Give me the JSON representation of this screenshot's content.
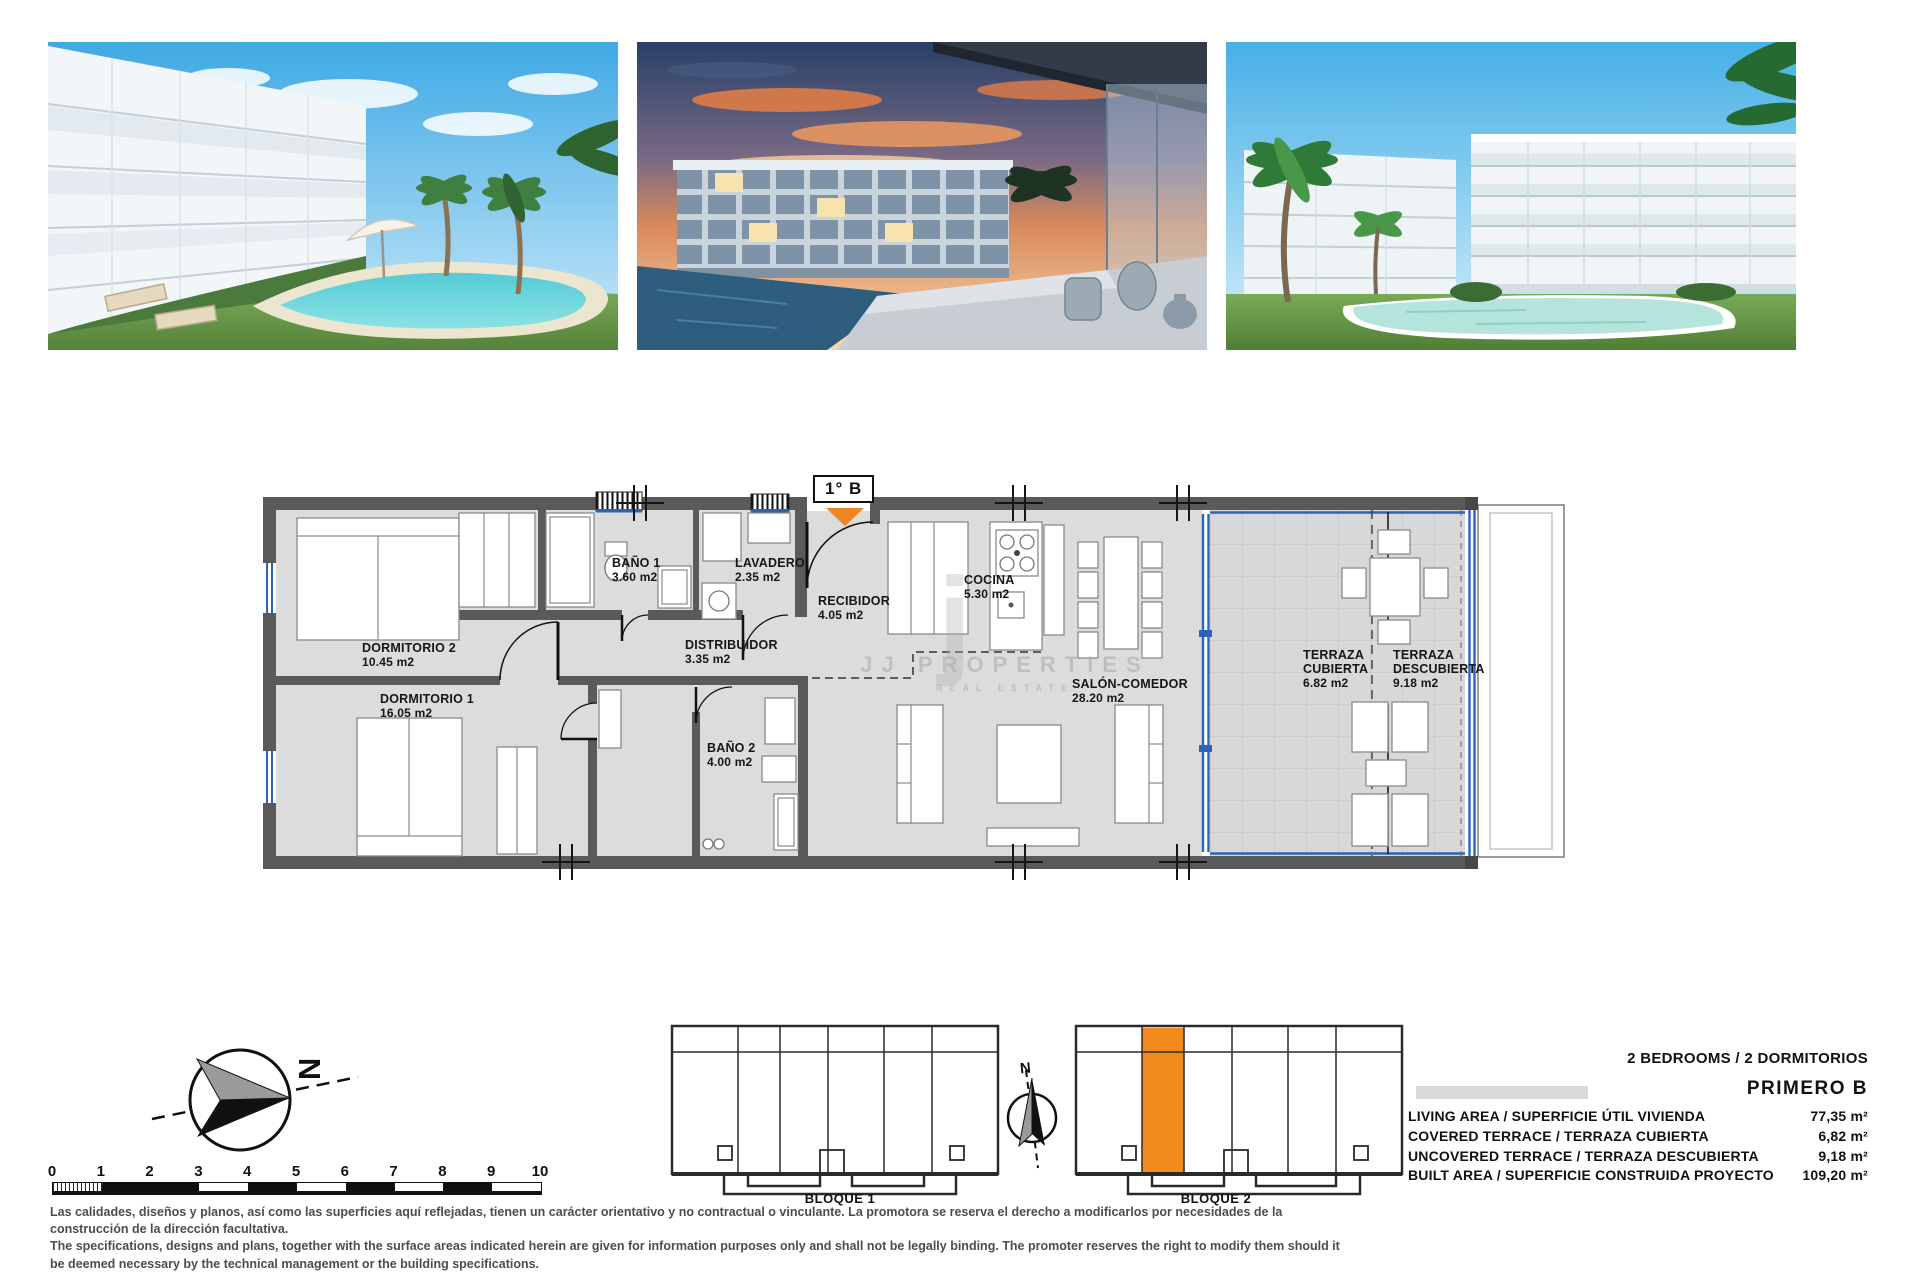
{
  "plan": {
    "unit_label": "1° B",
    "rooms": [
      {
        "name": "DORMITORIO 2",
        "area": "10.45 m2"
      },
      {
        "name": "DORMITORIO 1",
        "area": "16.05 m2"
      },
      {
        "name": "BAÑO 1",
        "area": "3.60 m2"
      },
      {
        "name": "LAVADERO",
        "area": "2.35 m2"
      },
      {
        "name": "RECIBIDOR",
        "area": "4.05 m2"
      },
      {
        "name": "DISTRIBUIDOR",
        "area": "3.35 m2"
      },
      {
        "name": "BAÑO 2",
        "area": "4.00 m2"
      },
      {
        "name": "COCINA",
        "area": "5.30 m2"
      },
      {
        "name": "SALÓN-COMEDOR",
        "area": "28.20 m2"
      },
      {
        "name": "TERRAZA CUBIERTA",
        "area": "6.82 m2"
      },
      {
        "name": "TERRAZA DESCUBIERTA",
        "area": "9.18 m2"
      }
    ],
    "watermark": {
      "initial": "j",
      "brand": "JJ PROPERTIES",
      "sub": "REAL ESTATE"
    }
  },
  "compass": {
    "north_label": "N"
  },
  "site": {
    "north_label": "N",
    "blocks": [
      {
        "label": "BLOQUE 1"
      },
      {
        "label": "BLOQUE 2"
      }
    ]
  },
  "scale_bar": {
    "labels": [
      "0",
      "1",
      "2",
      "3",
      "4",
      "5",
      "6",
      "7",
      "8",
      "9",
      "10"
    ]
  },
  "summary": {
    "bedrooms_line": "2 BEDROOMS / 2 DORMITORIOS",
    "unit_name": "PRIMERO B",
    "rows": [
      {
        "label": "LIVING AREA / SUPERFICIE ÚTIL VIVIENDA",
        "value": "77,35 m²"
      },
      {
        "label": "COVERED TERRACE / TERRAZA CUBIERTA",
        "value": "6,82 m²"
      },
      {
        "label": "UNCOVERED TERRACE / TERRAZA DESCUBIERTA",
        "value": "9,18 m²"
      },
      {
        "label": "BUILT AREA / SUPERFICIE CONSTRUIDA PROYECTO",
        "value": "109,20 m²"
      }
    ]
  },
  "disclaimer": {
    "es": "Las calidades, diseños y planos, así como las superficies aquí reflejadas, tienen un carácter orientativo y no contractual o vinculante. La promotora se reserva el derecho a modificarlos por necesidades de la construcción de la dirección facultativa.",
    "en": "The specifications, designs and plans, together with the surface areas indicated herein are given for information purposes only and shall not be legally binding. The promoter reserves the right to modify them should it be deemed necessary by the technical management or the building specifications."
  },
  "colors": {
    "wall": "#5a5a5a",
    "floor": "#dcdcdc",
    "glass_blue": "#2d62b8",
    "accent_orange": "#ee8722",
    "highlight_unit": "#f28a1e"
  }
}
